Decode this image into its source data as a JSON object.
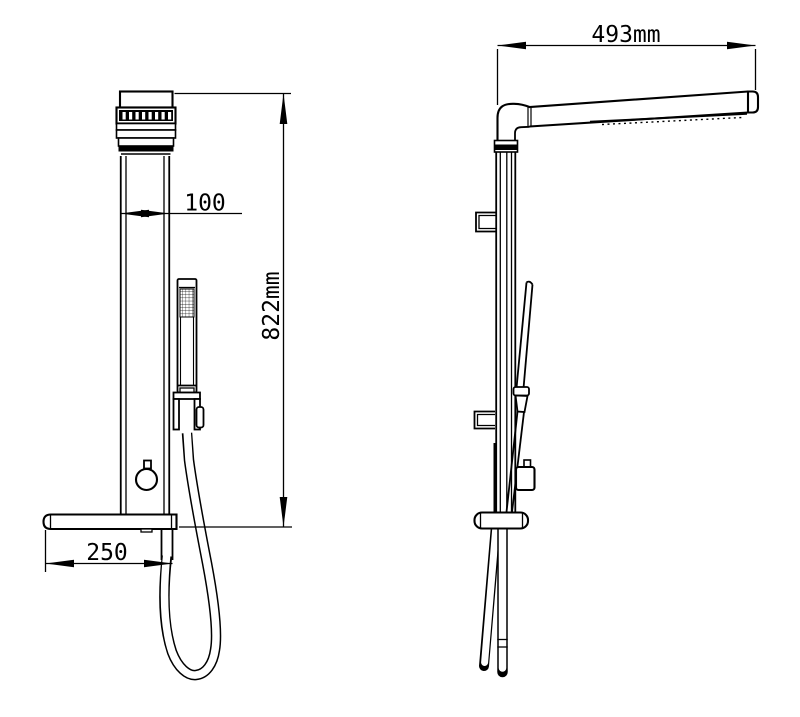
{
  "colors": {
    "line": "#000000",
    "background": "#ffffff"
  },
  "dimensions": {
    "side_view_head_width": "493mm",
    "front_panel_width": "100",
    "front_panel_height": "822mm",
    "front_shelf_width": "250"
  }
}
